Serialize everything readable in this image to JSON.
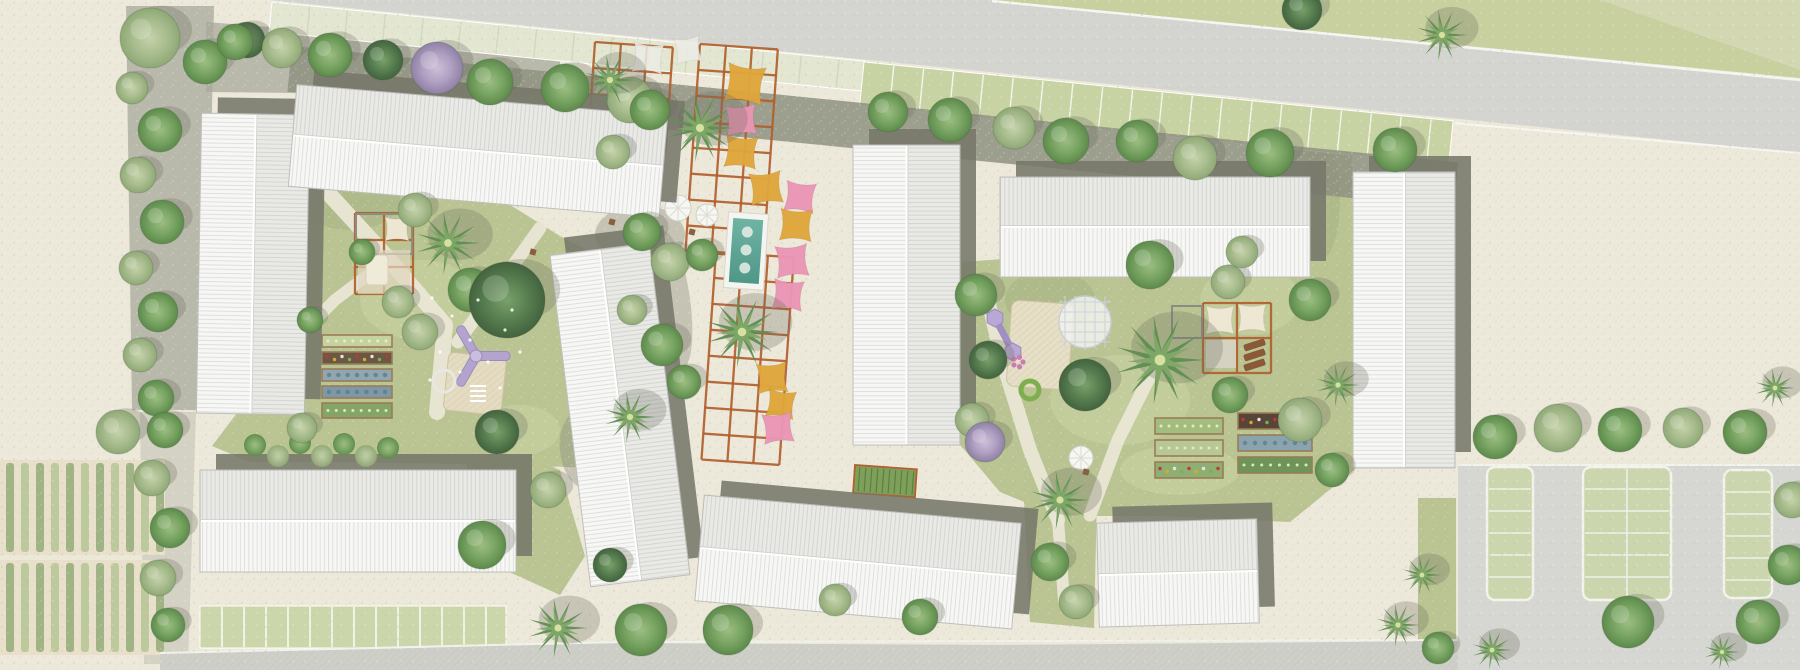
{
  "meta": {
    "kind": "architectural-site-plan",
    "width": 1800,
    "height": 670
  },
  "palette": {
    "gravel": "#ece8da",
    "gravel_dark": "#8e9080",
    "road": "#d4d4d0",
    "road_bottom": "#cfcfc9",
    "sidewalk": "#e3e7d2",
    "lawn": "#b9c492",
    "lawn_top": "#c7d09e",
    "lawn_pale": "#dcdfc2",
    "paver_green": "#c8d3a4",
    "bay_green": "#ccd6ae",
    "curb": "#f2f3ea",
    "roof_white": "#f7f7f5",
    "roof_line": "#dddddb",
    "shadow": "#76786a",
    "pergola": "#b2602e",
    "sail_yellow": "#DFA63C",
    "sail_pink": "#EA96B4",
    "sail_white": "#ECECE6",
    "sail_cream": "#EFE8D5",
    "water": "#5fa89a",
    "deck": "#f4f4f0",
    "soil": "#e8e0ca",
    "crop_row_a": "#9fb385",
    "crop_row_b": "#bcc99c",
    "play_purple": "#b3a4cf",
    "sand": "#e6dcbf",
    "wood": "#9a7c55"
  },
  "scene": {
    "road_top": {
      "poly": "270,0 992,0 1800,80 1800,153"
    },
    "lawn_top": {
      "poly": "992,0 1800,0 1800,78"
    },
    "lawn_top_fade": {
      "poly": "1600,0 1800,0 1800,70"
    },
    "bands": [
      {
        "name": "sidewalk-pavers",
        "x": 272,
        "y": 2,
        "len": 596,
        "w": 30,
        "angle": 5.7,
        "fill": "#e3e7d2",
        "tick": 38,
        "tickColor": "#d2d8bd"
      },
      {
        "name": "grass-parking-pavers",
        "x": 864,
        "y": 62,
        "len": 592,
        "w": 44,
        "angle": 5.7,
        "fill": "#c8d3a4",
        "tick": 30,
        "tickColor": "#f4f6ec"
      },
      {
        "name": "tree-strip-gravel",
        "x": 292,
        "y": 46,
        "len": 1172,
        "w": 46,
        "angle": 5.7,
        "fill": "#8e9080",
        "tick": 0,
        "op": 0.85
      },
      {
        "name": "parking-strip",
        "x": 200,
        "y": 606,
        "len": 306,
        "w": 42,
        "angle": 0,
        "fill": "#ccd6ab",
        "tick": 22,
        "tickColor": "#ffffff"
      }
    ],
    "gravel_strips": [
      {
        "poly": "126,6 214,6 206,410 132,410",
        "op": 0.75
      },
      {
        "poly": "206,22 560,50 560,96 206,92",
        "op": 0.75
      },
      {
        "poly": "140,412 196,412 188,664 144,664",
        "op": 0.35
      }
    ],
    "grass": [
      {
        "name": "courtyard-west",
        "poly": "308,118 390,142 470,180 560,236 650,282 652,420 600,468 470,464 320,462 250,462 212,446 300,330 296,200"
      },
      {
        "name": "courtyard-east",
        "poly": "962,262 1100,252 1290,262 1292,130 1352,126 1354,470 1290,522 1160,516 1058,516 1000,492 956,440"
      },
      {
        "name": "gap-south",
        "poly": "1022,462 1098,452 1094,628 1030,622"
      },
      {
        "name": "pocket-southwest",
        "poly": "470,430 560,470 585,556 560,595 505,570 462,510"
      },
      {
        "name": "strip-lot-west",
        "poly": "1418,498 1456,498 1456,670 1418,670"
      }
    ],
    "mottles": [
      [
        420,
        300,
        60,
        40,
        1
      ],
      [
        1120,
        400,
        70,
        45,
        1
      ],
      [
        520,
        430,
        40,
        25,
        1
      ],
      [
        1250,
        300,
        50,
        35,
        1
      ],
      [
        350,
        200,
        50,
        30,
        0
      ],
      [
        1050,
        300,
        45,
        30,
        0
      ],
      [
        620,
        330,
        30,
        40,
        0
      ],
      [
        1320,
        200,
        20,
        60,
        0
      ],
      [
        1180,
        470,
        60,
        25,
        1
      ]
    ],
    "paths": [
      {
        "pts": "330,195 385,255 445,325 437,412",
        "w": 16
      },
      {
        "pts": "540,228 492,295 458,342",
        "w": 13
      },
      {
        "pts": "300,335 335,300 385,262",
        "w": 12
      },
      {
        "pts": "985,287 1002,360 1030,450 1058,520",
        "w": 14
      },
      {
        "pts": "1152,372 1118,440 1090,515",
        "w": 13
      },
      {
        "pts": "1058,520 1064,600",
        "w": 12
      }
    ],
    "crops": {
      "blocks": [
        {
          "x": 0,
          "y": 460,
          "w": 165,
          "h": 95
        },
        {
          "x": 0,
          "y": 560,
          "w": 162,
          "h": 95
        }
      ],
      "row_step": 15,
      "row_w": 8
    },
    "lot": {
      "pavement": "1458,464 1800,464 1800,670 1458,670",
      "bays": [
        {
          "x": 1487,
          "y": 467,
          "w": 46,
          "h": 133,
          "center": false
        },
        {
          "x": 1583,
          "y": 467,
          "w": 88,
          "h": 133,
          "center": true
        },
        {
          "x": 1724,
          "y": 470,
          "w": 48,
          "h": 128,
          "center": false
        }
      ],
      "stall": 22
    },
    "road_bottom": {
      "poly": "160,654 620,643 1000,645 1458,641 1458,670 160,670",
      "curb": "160,653 620,642 1458,640"
    },
    "buildings": [
      {
        "name": "block-a",
        "x": 199,
        "y": 114,
        "w": 108,
        "h": 300,
        "rot": 1
      },
      {
        "name": "block-b",
        "x": 292,
        "y": 100,
        "w": 372,
        "h": 102,
        "rot": 4.8
      },
      {
        "name": "block-c",
        "x": 570,
        "y": 248,
        "w": 100,
        "h": 334,
        "rot": -7
      },
      {
        "name": "block-d",
        "x": 853,
        "y": 145,
        "w": 107,
        "h": 300,
        "rot": 0
      },
      {
        "name": "block-e",
        "x": 1000,
        "y": 177,
        "w": 310,
        "h": 100,
        "rot": 0
      },
      {
        "name": "block-f",
        "x": 1353,
        "y": 172,
        "w": 102,
        "h": 296,
        "rot": 0
      },
      {
        "name": "block-g",
        "x": 200,
        "y": 470,
        "w": 316,
        "h": 102,
        "rot": 0
      },
      {
        "name": "block-h",
        "x": 699,
        "y": 509,
        "w": 318,
        "h": 106,
        "rot": 5.1
      },
      {
        "name": "block-i",
        "x": 1098,
        "y": 521,
        "w": 160,
        "h": 104,
        "rot": -1.5
      }
    ],
    "pergola_grids": [
      {
        "x": 595,
        "y": 42,
        "cols": 3,
        "rows": 4,
        "cw": 26,
        "ch": 26,
        "rot": 4
      },
      {
        "x": 700,
        "y": 44,
        "cols": 3,
        "rows": 8,
        "cw": 26,
        "ch": 26,
        "rot": 4
      },
      {
        "x": 716,
        "y": 252,
        "cols": 3,
        "rows": 8,
        "cw": 26,
        "ch": 26,
        "rot": 4
      },
      {
        "x": 355,
        "y": 213,
        "cols": 2,
        "rows": 3,
        "cw": 29,
        "ch": 27,
        "rot": 0
      },
      {
        "x": 1203,
        "y": 303,
        "cols": 2,
        "rows": 2,
        "cw": 34,
        "ch": 35,
        "rot": 0
      }
    ],
    "gray_frames": [
      [
        356,
        214,
        56,
        40
      ],
      [
        1172,
        306,
        30,
        32
      ]
    ],
    "sails": [
      [
        745,
        84,
        19,
        "y",
        8
      ],
      [
        741,
        120,
        15,
        "p",
        -4
      ],
      [
        741,
        152,
        16,
        "y",
        5
      ],
      [
        766,
        188,
        16,
        "y",
        -6
      ],
      [
        800,
        197,
        15,
        "p",
        7
      ],
      [
        796,
        225,
        16,
        "y",
        3
      ],
      [
        792,
        261,
        16,
        "p",
        -5
      ],
      [
        788,
        295,
        15,
        "p",
        6
      ],
      [
        772,
        378,
        15,
        "y",
        -4
      ],
      [
        781,
        404,
        14,
        "y",
        8
      ],
      [
        778,
        428,
        15,
        "p",
        -6
      ],
      [
        648,
        58,
        15,
        "w",
        5
      ],
      [
        688,
        50,
        13,
        "w",
        -8
      ],
      [
        612,
        124,
        13,
        "w",
        4
      ],
      [
        397,
        229,
        12,
        "c",
        0
      ],
      [
        1220,
        320,
        14,
        "c",
        0
      ],
      [
        1252,
        318,
        14,
        "c",
        0
      ]
    ],
    "pool": {
      "x": 726,
      "y": 213,
      "w": 40,
      "h": 76,
      "rot": 4,
      "jets": [
        232,
        250,
        268
      ]
    },
    "parasols": [
      [
        678,
        208,
        13
      ],
      [
        707,
        215,
        11
      ],
      [
        1081,
        458,
        12
      ]
    ],
    "tables": [
      [
        612,
        222
      ],
      [
        628,
        238
      ],
      [
        692,
        232
      ],
      [
        533,
        252
      ],
      [
        1086,
        472
      ]
    ],
    "beds_west": {
      "x": 322,
      "w": 70,
      "rows": [
        [
          335,
          12,
          "#c6d1a0",
          0
        ],
        [
          352,
          12,
          "#6a5845",
          1
        ],
        [
          369,
          12,
          "#90a6b0",
          2
        ],
        [
          386,
          12,
          "#7e98a8",
          2
        ],
        [
          403,
          15,
          "#85a567",
          0
        ]
      ]
    },
    "beds_east_a": {
      "x": 1155,
      "w": 68,
      "rows": [
        [
          418,
          16,
          "#a3bd7f",
          0
        ],
        [
          440,
          16,
          "#b7c795",
          0
        ],
        [
          462,
          16,
          "#8fae74",
          1
        ]
      ]
    },
    "beds_east_b": {
      "x": 1238,
      "w": 74,
      "rows": [
        [
          413,
          16,
          "#57453a",
          1
        ],
        [
          435,
          16,
          "#8ba3ad",
          2
        ],
        [
          457,
          16,
          "#6f9458",
          0
        ]
      ]
    },
    "deck_left": {
      "x": 358,
      "y": 250,
      "w": 52,
      "h": 44
    },
    "mattress_left": {
      "x": 366,
      "y": 255,
      "w": 22,
      "h": 30
    },
    "deck_right": {
      "x": 1206,
      "y": 340,
      "w": 30,
      "h": 28
    },
    "loungers_right": [
      [
        1243,
        345
      ],
      [
        1243,
        355
      ],
      [
        1243,
        365
      ]
    ],
    "trellis": {
      "x": 855,
      "y": 465,
      "w": 62,
      "h": 28,
      "rot": 4
    },
    "play_west": {
      "hub": [
        476,
        356
      ],
      "ring": [
        444,
        381
      ],
      "sand": [
        449,
        352,
        58,
        58,
        6
      ],
      "ladder": [
        470,
        386
      ]
    },
    "play_east": {
      "pods": [
        [
          995,
          318
        ],
        [
          1013,
          352
        ]
      ],
      "sand": [
        1012,
        300,
        62,
        86,
        4
      ],
      "dome": [
        1085,
        322,
        26
      ],
      "donut": [
        1030,
        390
      ],
      "spinner": [
        1018,
        362
      ]
    },
    "hedges": [
      [
        255,
        445
      ],
      [
        278,
        456
      ],
      [
        300,
        443
      ],
      [
        322,
        456
      ],
      [
        344,
        444
      ],
      [
        366,
        456
      ],
      [
        388,
        448
      ]
    ],
    "trees": [
      [
        "sage",
        150,
        38,
        30
      ],
      [
        "green",
        205,
        62,
        22
      ],
      [
        "dark",
        247,
        40,
        18
      ],
      [
        "sage",
        132,
        88,
        16
      ],
      [
        "green",
        160,
        130,
        22
      ],
      [
        "sage",
        138,
        175,
        18
      ],
      [
        "green",
        162,
        222,
        22
      ],
      [
        "sage",
        136,
        268,
        17
      ],
      [
        "green",
        158,
        312,
        20
      ],
      [
        "sage",
        140,
        355,
        17
      ],
      [
        "green",
        156,
        398,
        18
      ],
      [
        "sage",
        118,
        432,
        22
      ],
      [
        "green",
        165,
        430,
        18
      ],
      [
        "sage",
        152,
        478,
        18
      ],
      [
        "green",
        170,
        528,
        20
      ],
      [
        "sage",
        158,
        578,
        18
      ],
      [
        "green",
        168,
        625,
        17
      ],
      [
        "green",
        235,
        42,
        18
      ],
      [
        "sage",
        282,
        48,
        20
      ],
      [
        "green",
        330,
        55,
        22
      ],
      [
        "dark",
        383,
        60,
        20
      ],
      [
        "lilac",
        437,
        68,
        26
      ],
      [
        "green",
        490,
        82,
        23
      ],
      [
        "green",
        565,
        88,
        24
      ],
      [
        "sage",
        630,
        100,
        23
      ],
      [
        "palm",
        610,
        80,
        26
      ],
      [
        "green",
        650,
        110,
        20
      ],
      [
        "sage",
        613,
        152,
        17
      ],
      [
        "palm",
        700,
        128,
        34
      ],
      [
        "green",
        642,
        232,
        19
      ],
      [
        "sage",
        670,
        262,
        19
      ],
      [
        "green",
        702,
        255,
        16
      ],
      [
        "palm",
        742,
        332,
        36
      ],
      [
        "green",
        662,
        345,
        21
      ],
      [
        "sage",
        632,
        310,
        15
      ],
      [
        "palm",
        630,
        417,
        26
      ],
      [
        "green",
        684,
        382,
        17
      ],
      [
        "green",
        888,
        112,
        20
      ],
      [
        "green",
        950,
        120,
        22
      ],
      [
        "sage",
        1014,
        128,
        21
      ],
      [
        "green",
        1066,
        141,
        23
      ],
      [
        "green",
        1137,
        141,
        21
      ],
      [
        "sage",
        1195,
        158,
        22
      ],
      [
        "green",
        1270,
        153,
        24
      ],
      [
        "green",
        1395,
        150,
        22
      ],
      [
        "palm",
        1442,
        35,
        26
      ],
      [
        "dark",
        1302,
        10,
        20
      ],
      [
        "palm",
        448,
        243,
        32
      ],
      [
        "sage",
        415,
        210,
        17
      ],
      [
        "green",
        470,
        290,
        22
      ],
      [
        "dark",
        507,
        300,
        38
      ],
      [
        "sage",
        398,
        302,
        16
      ],
      [
        "green",
        362,
        252,
        13
      ],
      [
        "sage",
        420,
        332,
        18
      ],
      [
        "green",
        310,
        320,
        13
      ],
      [
        "sage",
        302,
        428,
        15
      ],
      [
        "green",
        976,
        295,
        21
      ],
      [
        "dark",
        988,
        360,
        19
      ],
      [
        "sage",
        972,
        420,
        17
      ],
      [
        "green",
        1150,
        265,
        24
      ],
      [
        "palm",
        1160,
        360,
        45
      ],
      [
        "dark",
        1085,
        385,
        26
      ],
      [
        "sage",
        1228,
        282,
        17
      ],
      [
        "green",
        1310,
        300,
        21
      ],
      [
        "sage",
        1300,
        420,
        22
      ],
      [
        "green",
        1230,
        395,
        18
      ],
      [
        "palm",
        1338,
        385,
        22
      ],
      [
        "green",
        1332,
        470,
        17
      ],
      [
        "sage",
        1242,
        252,
        16
      ],
      [
        "lilac",
        985,
        442,
        20
      ],
      [
        "palm",
        1060,
        500,
        30
      ],
      [
        "green",
        1050,
        562,
        19
      ],
      [
        "sage",
        1076,
        602,
        17
      ],
      [
        "dark",
        497,
        432,
        22
      ],
      [
        "green",
        482,
        545,
        24
      ],
      [
        "sage",
        548,
        490,
        18
      ],
      [
        "dark",
        610,
        565,
        17
      ],
      [
        "palm",
        558,
        628,
        30
      ],
      [
        "green",
        641,
        630,
        26
      ],
      [
        "green",
        728,
        630,
        25
      ],
      [
        "green",
        920,
        617,
        18
      ],
      [
        "sage",
        835,
        600,
        16
      ],
      [
        "green",
        1495,
        437,
        22
      ],
      [
        "sage",
        1558,
        428,
        24
      ],
      [
        "green",
        1620,
        430,
        22
      ],
      [
        "sage",
        1683,
        428,
        20
      ],
      [
        "green",
        1745,
        432,
        22
      ],
      [
        "green",
        1628,
        622,
        26
      ],
      [
        "palm",
        1492,
        650,
        20
      ],
      [
        "green",
        1758,
        622,
        22
      ],
      [
        "palm",
        1722,
        652,
        18
      ],
      [
        "sage",
        1792,
        500,
        18
      ],
      [
        "green",
        1788,
        565,
        20
      ],
      [
        "palm",
        1775,
        388,
        20
      ],
      [
        "palm",
        1422,
        575,
        20
      ],
      [
        "palm",
        1398,
        625,
        22
      ],
      [
        "green",
        1438,
        648,
        16
      ]
    ],
    "flowers": [
      [
        432,
        298
      ],
      [
        452,
        316
      ],
      [
        470,
        340
      ],
      [
        488,
        362
      ],
      [
        505,
        330
      ],
      [
        460,
        372
      ],
      [
        440,
        352
      ],
      [
        478,
        300
      ],
      [
        500,
        388
      ],
      [
        430,
        380
      ],
      [
        520,
        352
      ],
      [
        512,
        310
      ]
    ],
    "dark_patches": [
      [
        640,
        235,
        45,
        30,
        0
      ],
      [
        672,
        300,
        18,
        70,
        -8
      ],
      [
        585,
        450,
        25,
        40,
        -8
      ]
    ]
  }
}
